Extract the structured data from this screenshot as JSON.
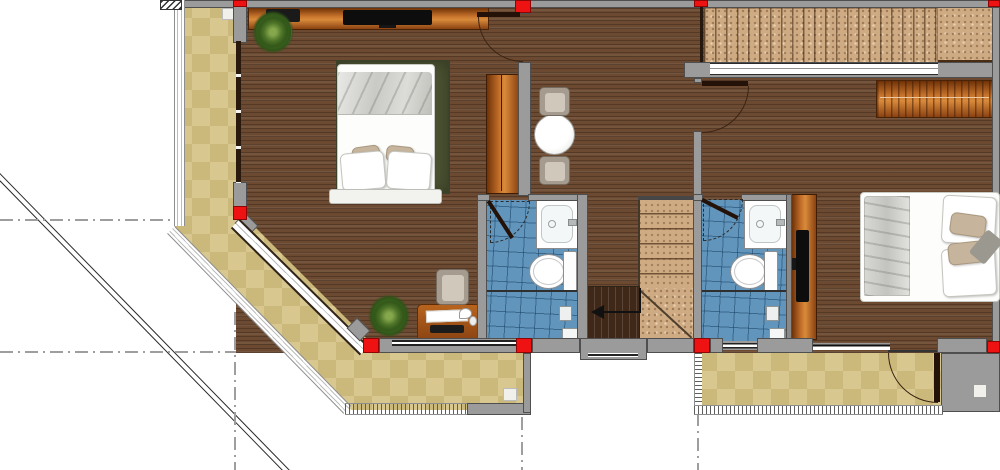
{
  "meta": {
    "type": "architectural-floor-plan",
    "view": "top-down 2d color render",
    "visible_text": "none"
  },
  "colors": {
    "wood": "#6b4a31",
    "wood_dark": "#3f2817",
    "tile_terrace_a": "#d8c890",
    "tile_terrace_b": "#cbb97b",
    "tile_bath": "#6295bc",
    "wall": "#9b9b9b",
    "wall_dark": "#4f4f4f",
    "column": "#ee1212",
    "granite": "#cfab83",
    "rug": "#4b5231",
    "orange_light": "#d98a3a",
    "orange_dark": "#6e3208",
    "balustrade": "#ffffff",
    "reference_line": "#9e9e9e",
    "roof_line": "#2a2a2a"
  },
  "rooms": [
    {
      "id": "bedroom-left",
      "furniture": [
        "double-bed",
        "area-rug",
        "tv-console",
        "tv",
        "wardrobe",
        "desk",
        "desk-chair",
        "potted-plant-corner",
        "potted-plant-desk"
      ]
    },
    {
      "id": "hallway",
      "furniture": [
        "round-table",
        "chair-north",
        "chair-south"
      ]
    },
    {
      "id": "bathroom-left",
      "fixtures": [
        "vanity-sink",
        "toilet",
        "shower-partition",
        "floor-drain"
      ]
    },
    {
      "id": "bathroom-right",
      "fixtures": [
        "vanity-sink",
        "toilet",
        "shower-partition",
        "floor-drain"
      ]
    },
    {
      "id": "bedroom-right",
      "furniture": [
        "double-bed",
        "dresser",
        "wardrobe-tv-unit"
      ]
    },
    {
      "id": "staircase",
      "parts": [
        "upper-flight",
        "landing",
        "lower-flight",
        "direction-arrow"
      ]
    },
    {
      "id": "terrace-left",
      "parts": [
        "ceramic-tile-floor",
        "balustrade"
      ]
    },
    {
      "id": "terrace-right",
      "parts": [
        "ceramic-tile-floor",
        "dotted-balustrade",
        "service-block"
      ]
    },
    {
      "id": "deck-top-right",
      "parts": [
        "wood-plank-deck",
        "gravel-strip",
        "long-window"
      ]
    }
  ],
  "annotations": [
    "roof-overhang-diagonal",
    "grid-dash-lines",
    "red-structural-columns"
  ]
}
